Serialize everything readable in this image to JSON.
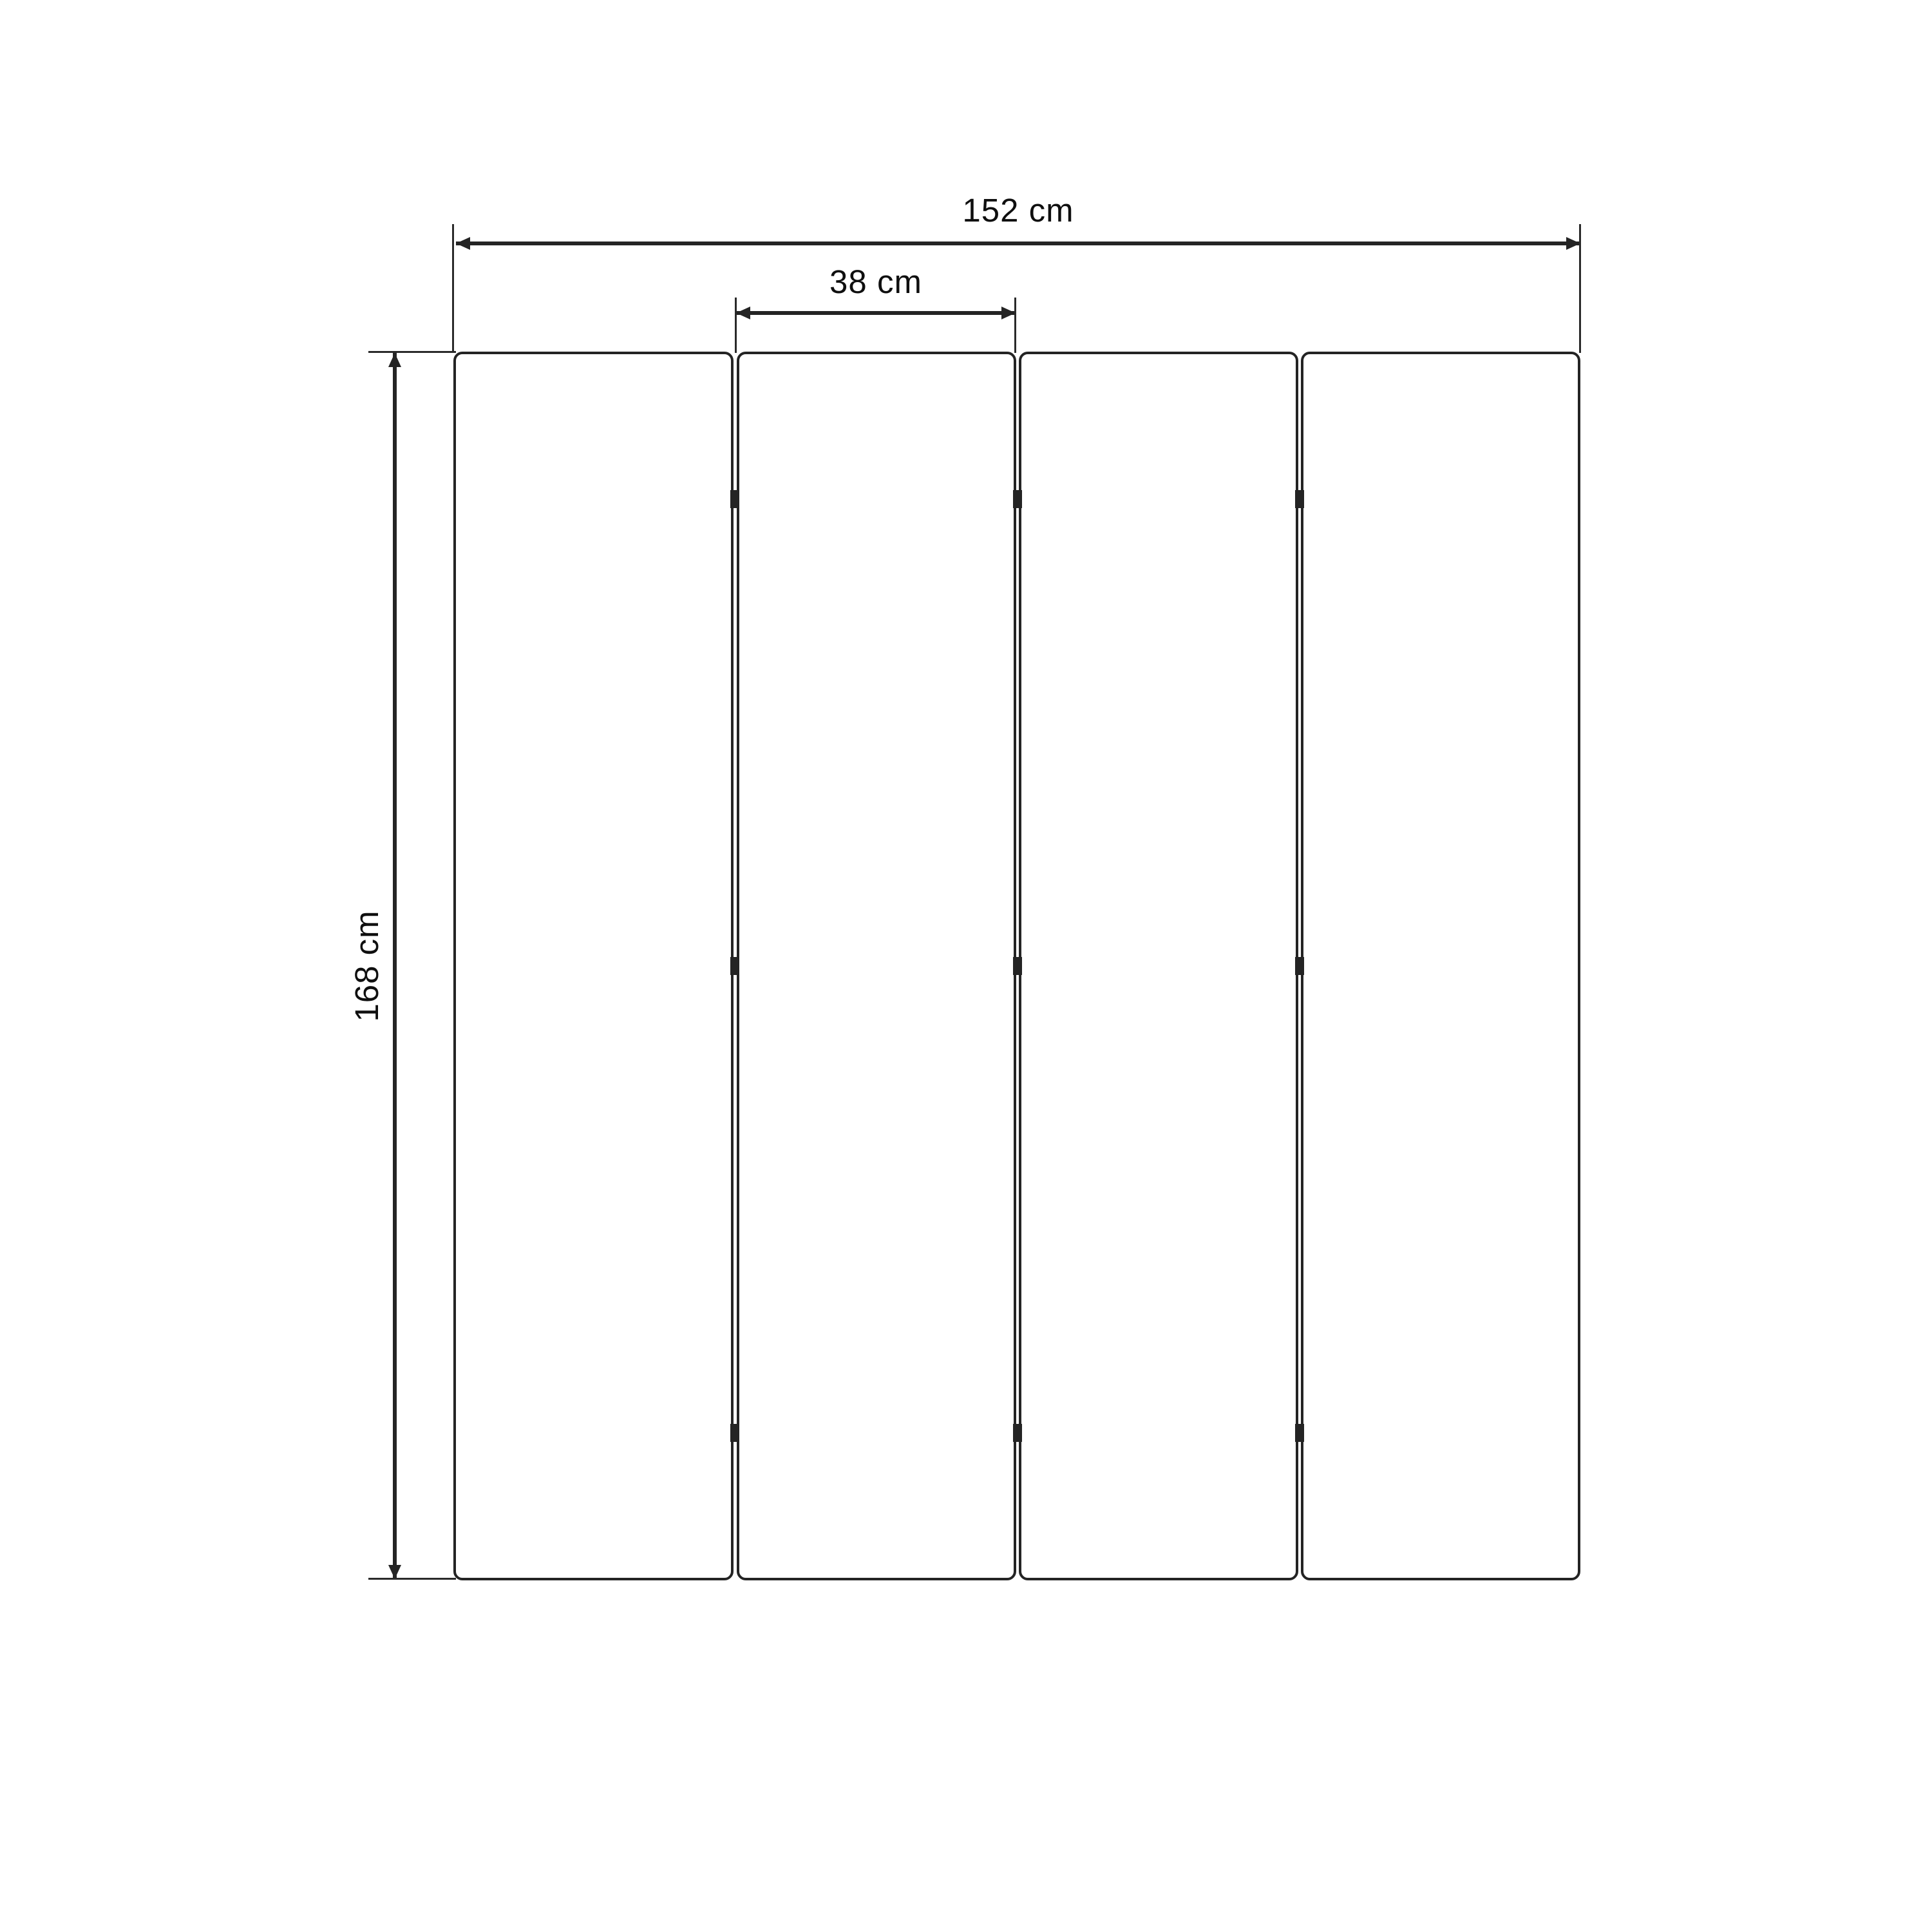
{
  "diagram": {
    "dimensions": {
      "total_width": {
        "label": "152 cm",
        "value": 152,
        "unit": "cm"
      },
      "panel_width": {
        "label": "38 cm",
        "value": 38,
        "unit": "cm"
      },
      "height": {
        "label": "168 cm",
        "value": 168,
        "unit": "cm"
      }
    },
    "structure": {
      "panel_count": 4,
      "gap_count": 3,
      "hinges_per_gap": 3
    },
    "colors": {
      "stroke": "#242424",
      "text": "#0f0f0f",
      "background": "#ffffff"
    }
  }
}
